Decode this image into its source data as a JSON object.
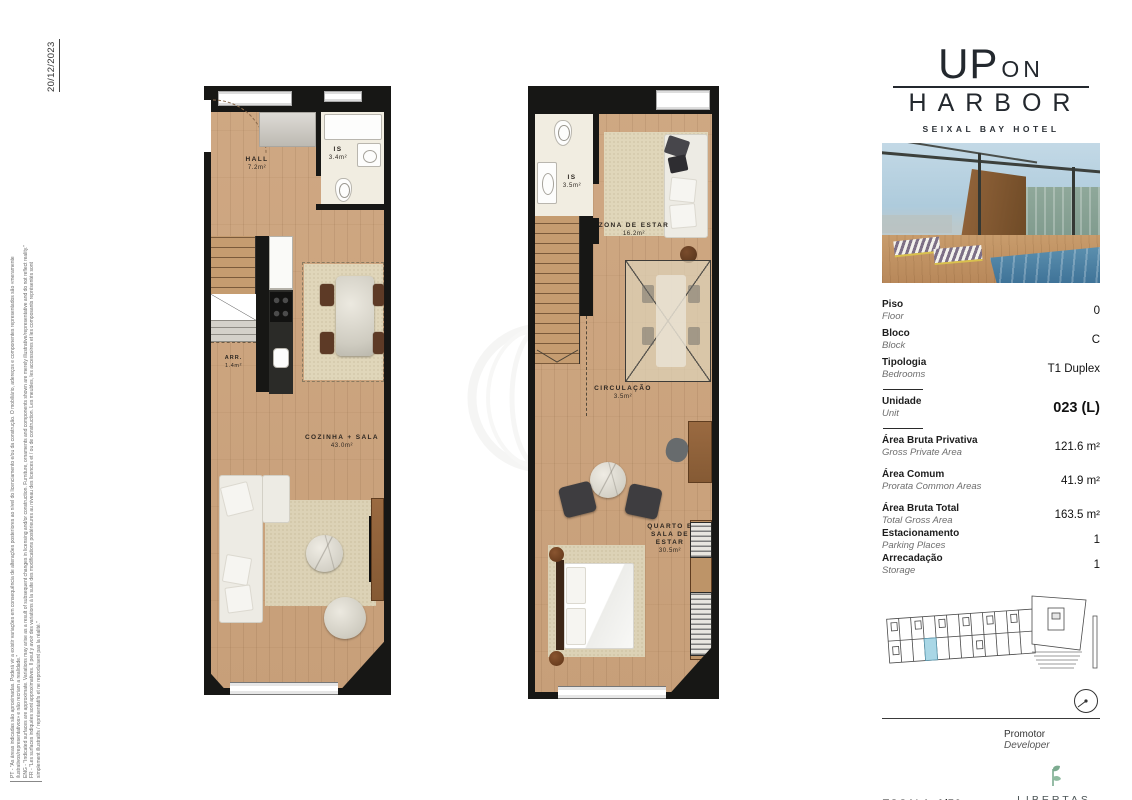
{
  "meta": {
    "date": "20/12/2023"
  },
  "disclaimer_lines": [
    "PT - \"As áreas indicadas são aproximadas. Poderá vir a existir variações em consequência de alterações posteriores ao nível do licenciamento e/ou da construção. O mobiliário, adereços e componentes representados são «meramente",
    "ilustrativos/representativos» e não recriam a realidade.\"",
    "ENG - \"Indicated surfaces are approximate. Variations may arise as a result of subsequent changes in licensing and/or construction. Furniture, ornaments and components shown are merely illustrative/representative and do not reflect reality.\"",
    "FR - \"Les surfaces indiquées sont approximatives. Il peut y avoir des variations à la suite des modifications postérieures au niveau des licences et / ou de construction. Les meubles, les accessoires et les composants représentés sont",
    "simplement illustratifs / représentatifs et ne reproduisent pas la réalité.\""
  ],
  "brand": {
    "up": "UP",
    "on": "ON",
    "harbor": "HARBOR",
    "subtitle": "SEIXAL BAY HOTEL"
  },
  "details": {
    "floor": {
      "pt": "Piso",
      "en": "Floor",
      "value": "0"
    },
    "block": {
      "pt": "Bloco",
      "en": "Block",
      "value": "C"
    },
    "typology": {
      "pt": "Tipologia",
      "en": "Bedrooms",
      "value": "T1 Duplex"
    },
    "unit": {
      "pt": "Unidade",
      "en": "Unit",
      "value": "023 (L)"
    },
    "gross_private": {
      "pt": "Área Bruta Privativa",
      "en": "Gross Private Area",
      "value": "121.6 m²"
    },
    "common": {
      "pt": "Área Comum",
      "en": "Prorata Common Areas",
      "value": "41.9 m²"
    },
    "gross_total": {
      "pt": "Área Bruta Total",
      "en": "Total Gross Area",
      "value": "163.5 m²"
    },
    "parking": {
      "pt": "Estacionamento",
      "en": "Parking Places",
      "value": "1"
    },
    "storage": {
      "pt": "Arrecadação",
      "en": "Storage",
      "value": "1"
    }
  },
  "plans": {
    "floor0": {
      "rooms": {
        "hall": {
          "name": "HALL",
          "area": "7.2m²"
        },
        "is": {
          "name": "IS",
          "area": "3.4m²"
        },
        "arr": {
          "name": "ARR.",
          "area": "1.4m²"
        },
        "living": {
          "name": "COZINHA + SALA",
          "area": "43.0m²"
        }
      }
    },
    "floor1": {
      "rooms": {
        "is": {
          "name": "IS",
          "area": "3.5m²"
        },
        "zona": {
          "name": "ZONA DE ESTAR",
          "area": "16.2m²"
        },
        "circ": {
          "name": "CIRCULAÇÃO",
          "area": "3.5m²"
        },
        "quarto": {
          "name": "QUARTO E SALA DE ESTAR",
          "area": "30.5m²"
        }
      }
    }
  },
  "footer": {
    "promoter_pt": "Promotor",
    "promoter_en": "Developer",
    "scale_label": "ESCALA:",
    "scale_value": "1/50",
    "developer": "LIBERTAS",
    "developer_tagline": "GRUPO IMOBILIÁRIO"
  },
  "colors": {
    "highlight": "#a9d7e6",
    "wall": "#171715",
    "wood": "#cba683",
    "brand_green": "#7cab90"
  }
}
